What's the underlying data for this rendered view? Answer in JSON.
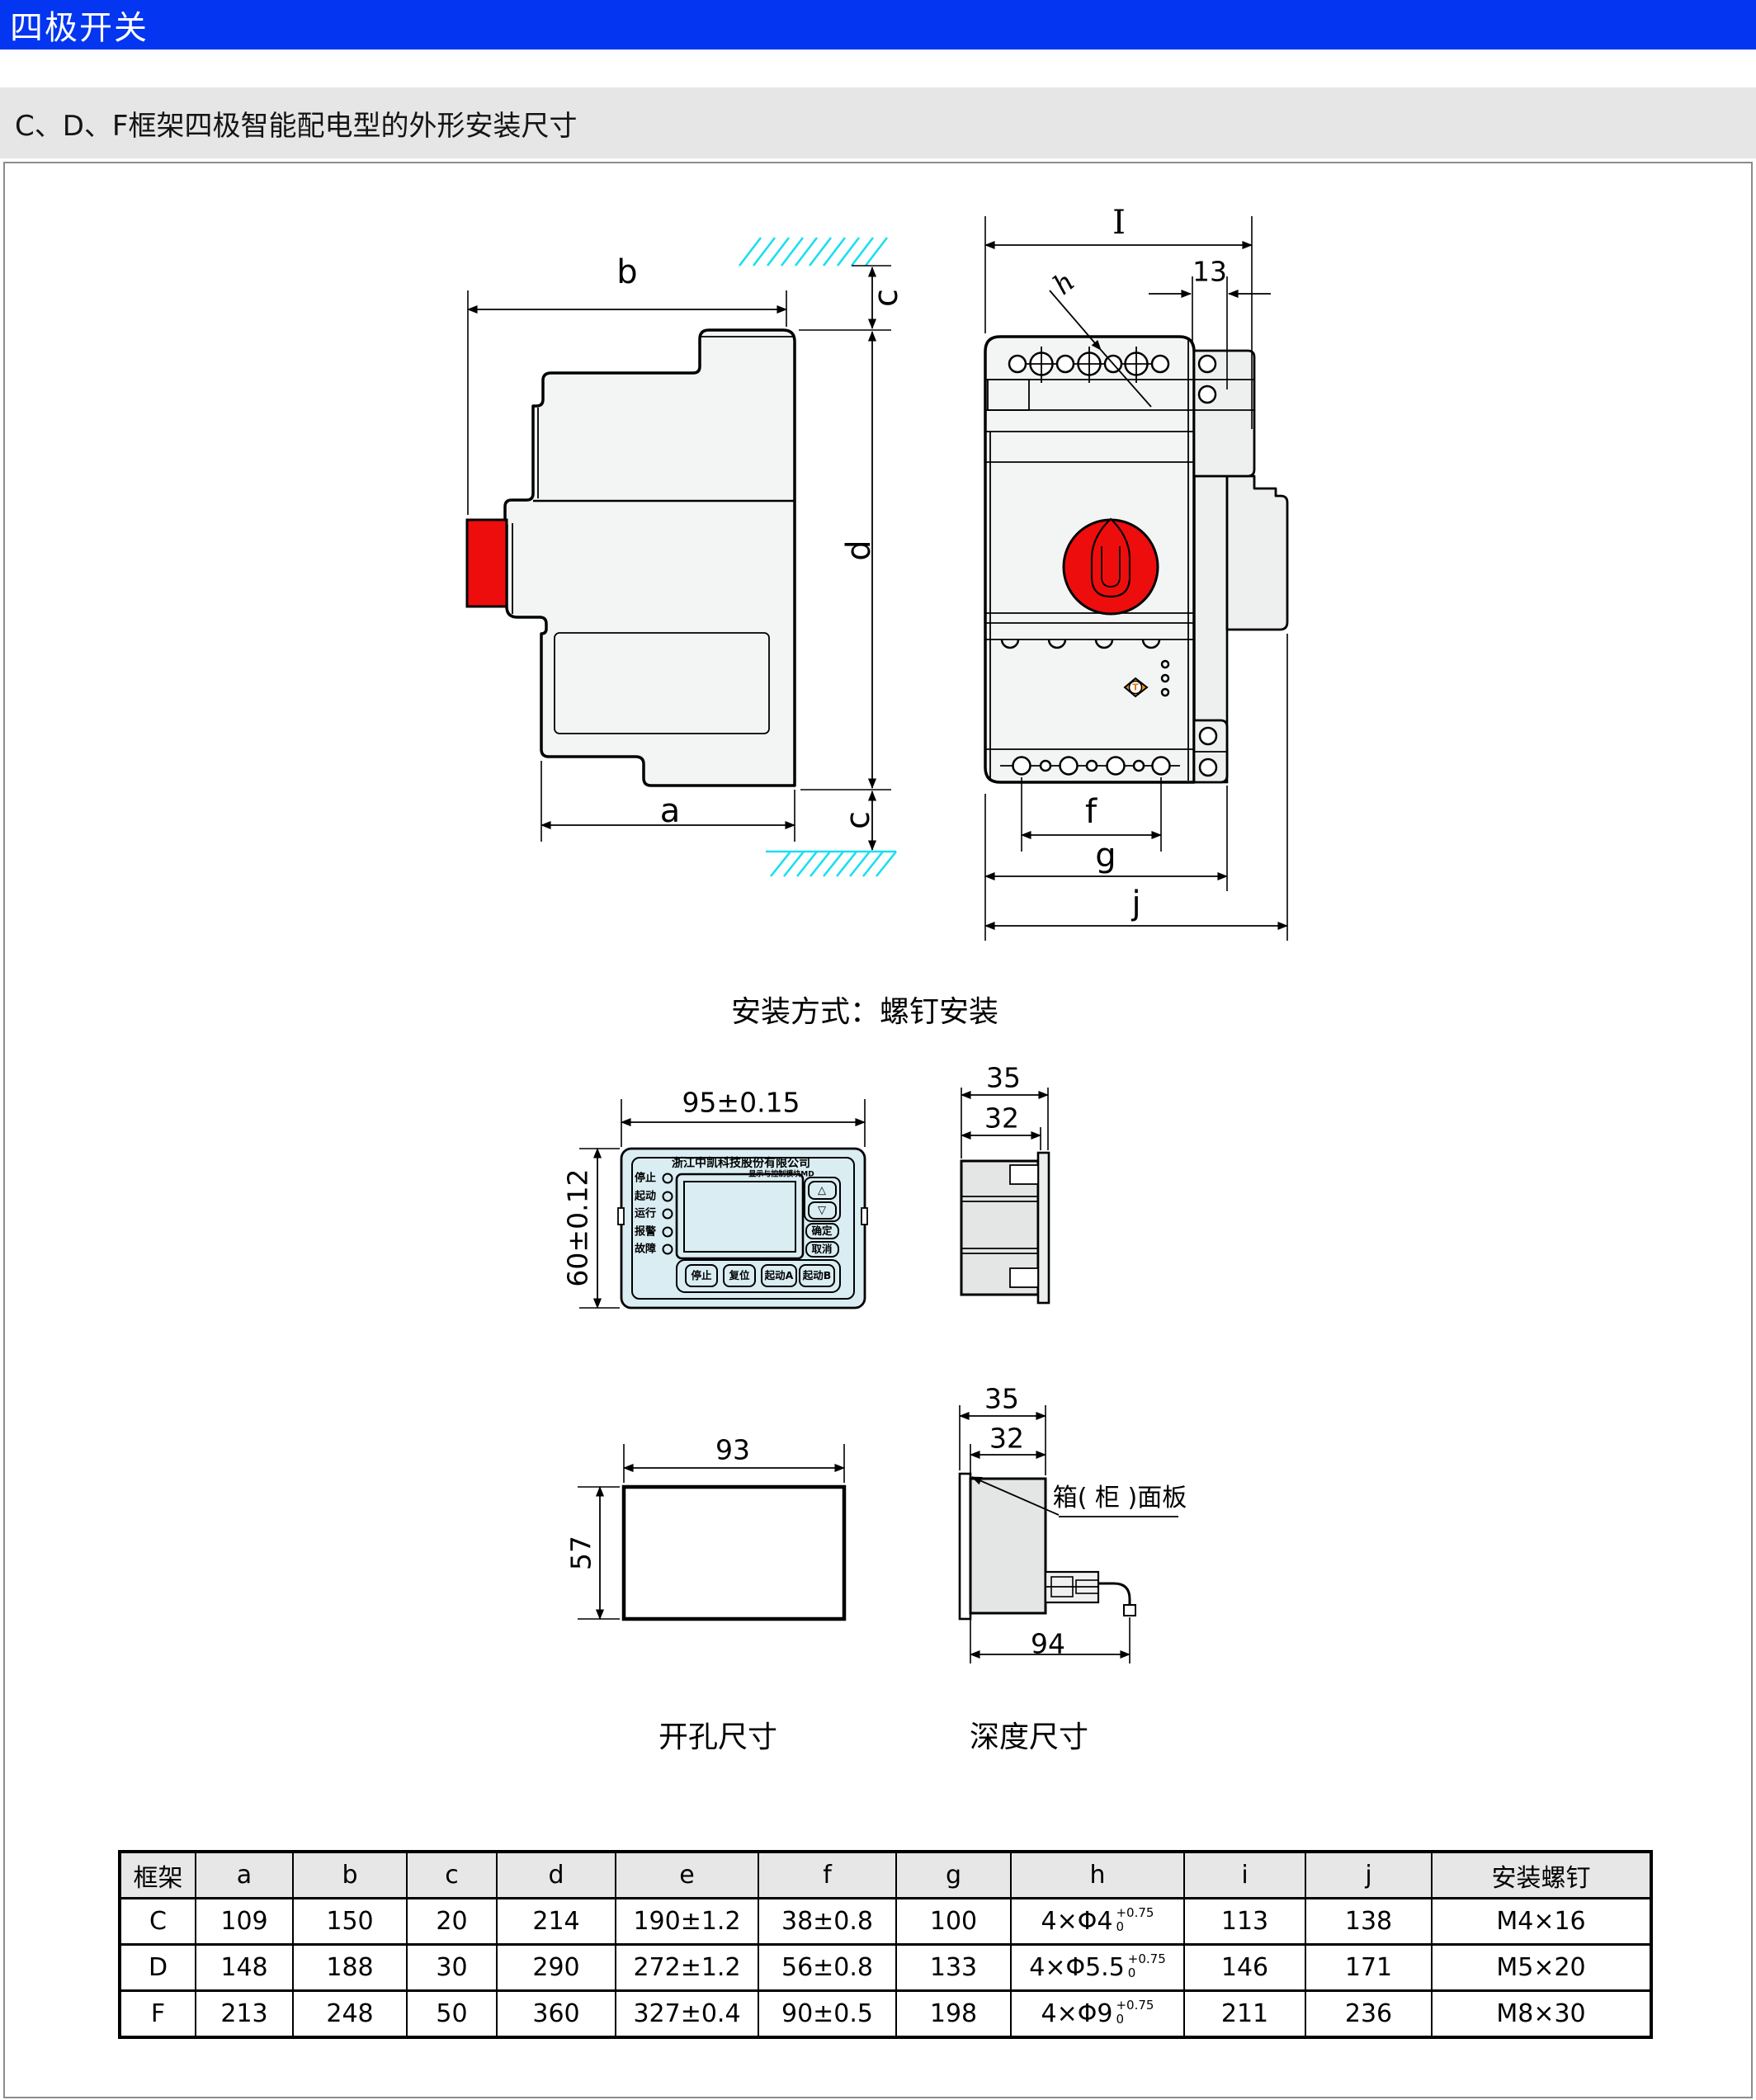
{
  "header": {
    "title": "四极开关"
  },
  "subtitle": "C、D、F框架四极智能配电型的外形安装尺寸",
  "side_view": {
    "dim_b": "b",
    "dim_c_top": "c",
    "dim_d": "d",
    "dim_a": "a",
    "dim_c_bottom": "c"
  },
  "front_view": {
    "dim_overall_width": "I",
    "dim_13": "13",
    "dim_hole": "h",
    "dim_f": "f",
    "dim_g": "g",
    "dim_j": "j",
    "test_button": "T"
  },
  "captions": {
    "mounting": "安装方式：螺钉安装",
    "cutout": "开孔尺寸",
    "depth": "深度尺寸"
  },
  "panel": {
    "dim_width": "95±0.15",
    "dim_height": "60±0.12",
    "company": "浙江中凯科技股份有限公司",
    "module_label": "显示与控制模块MD",
    "leds": [
      "停止",
      "起动",
      "运行",
      "报警",
      "故障"
    ],
    "btn_up": "△",
    "btn_down": "▽",
    "btn_confirm": "确定",
    "btn_cancel": "取消",
    "bottom_buttons": [
      "停止",
      "复位",
      "起动A",
      "起动B"
    ],
    "side_dim_35": "35",
    "side_dim_32": "32"
  },
  "cutout": {
    "dim_width": "93",
    "dim_height": "57"
  },
  "depth": {
    "dim_35": "35",
    "dim_32": "32",
    "panel_label": "箱( 柜 )面板",
    "dim_94": "94"
  },
  "table": {
    "headers": [
      "框架",
      "a",
      "b",
      "c",
      "d",
      "e",
      "f",
      "g",
      "h",
      "i",
      "j",
      "安装螺钉"
    ],
    "rows": [
      {
        "frame": "C",
        "a": "109",
        "b": "150",
        "c": "20",
        "d": "214",
        "e": "190±1.2",
        "f": "38±0.8",
        "g": "100",
        "h_base": "4×Φ4",
        "h_sup": "+0.75",
        "h_sub": "0",
        "i": "113",
        "j": "138",
        "screw": "M4×16"
      },
      {
        "frame": "D",
        "a": "148",
        "b": "188",
        "c": "30",
        "d": "290",
        "e": "272±1.2",
        "f": "56±0.8",
        "g": "133",
        "h_base": "4×Φ5.5",
        "h_sup": "+0.75",
        "h_sub": "0",
        "i": "146",
        "j": "171",
        "screw": "M5×20"
      },
      {
        "frame": "F",
        "a": "213",
        "b": "248",
        "c": "50",
        "d": "360",
        "e": "327±0.4",
        "f": "90±0.5",
        "g": "198",
        "h_base": "4×Φ9",
        "h_sup": "+0.75",
        "h_sub": "0",
        "i": "211",
        "j": "236",
        "screw": "M8×30"
      }
    ]
  }
}
